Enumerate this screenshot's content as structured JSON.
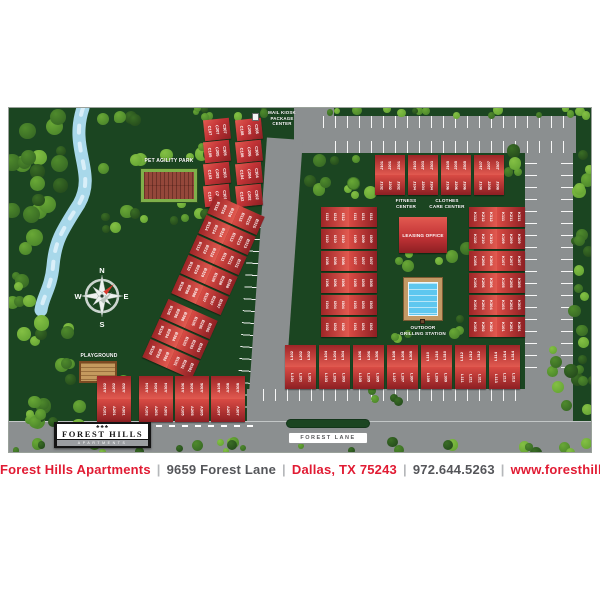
{
  "map": {
    "background": "#1b4521",
    "road_color": "#8b8f90",
    "building_color": "#c53437",
    "water_color": "#a8d8ea",
    "pool_color": "#5ec7ef",
    "labels": {
      "mail_kiosk": [
        "MAIL KIOSK",
        "PACKAGE",
        "CENTER"
      ],
      "pet_agility_park": "PET AGILITY PARK",
      "playground": "PLAYGROUND",
      "fitness_center": [
        "FITNESS",
        "CENTER"
      ],
      "clothes_care_center": [
        "CLOTHES",
        "CARE CENTER"
      ],
      "leasing_office": "LEASING OFFICE",
      "outdoor_grilling": [
        "OUTDOOR",
        "GRILLING STATION"
      ],
      "forest_lane": "FOREST LANE"
    },
    "compass": {
      "n": "N",
      "e": "E",
      "s": "S",
      "w": "W"
    },
    "buildings": {
      "C": [
        [
          "C107",
          "C207",
          "C307"
        ],
        [
          "C108",
          "C208",
          "C308"
        ],
        [
          "C105",
          "C205",
          "C305"
        ],
        [
          "C106",
          "C206",
          "C306"
        ],
        [
          "C103",
          "C203",
          "C303"
        ],
        [
          "C104",
          "C204",
          "C304"
        ],
        [
          "C101",
          "C201",
          "C301"
        ],
        [
          "C102",
          "C202",
          "C302"
        ]
      ],
      "B": [
        [
          [
            "B116",
            "B216",
            "B316"
          ],
          [
            "B115",
            "B215",
            "B315"
          ]
        ],
        [
          [
            "B114",
            "B214",
            "B314"
          ],
          [
            "B113",
            "B213",
            "B313"
          ]
        ],
        [
          [
            "B112",
            "B212",
            "B312"
          ],
          [
            "B111",
            "B211",
            "B311"
          ]
        ],
        [
          [
            "B110",
            "B210",
            "B310"
          ],
          [
            "B109",
            "B209",
            "B309"
          ]
        ],
        [
          [
            "B108",
            "B208",
            "B308"
          ],
          [
            "B107",
            "B207",
            "B307"
          ]
        ],
        [
          [
            "B106",
            "B206",
            "B306"
          ],
          [
            "B105",
            "B205",
            "B305"
          ]
        ],
        [
          [
            "B104",
            "B204",
            "B304"
          ],
          [
            "B103",
            "B203",
            "B303"
          ]
        ],
        [
          [
            "B102",
            "B202",
            "B302"
          ],
          [
            "B101",
            "B201",
            "B301"
          ]
        ]
      ],
      "A": [
        [
          [
            "A102",
            "A202",
            "A302"
          ],
          [
            "A101",
            "A201",
            "A301"
          ]
        ],
        [
          [
            "A104",
            "A204",
            "A304"
          ],
          [
            "A103",
            "A203",
            "A303"
          ]
        ],
        [
          [
            "A106",
            "A206",
            "A306"
          ],
          [
            "A105",
            "A205",
            "A305"
          ]
        ],
        [
          [
            "A108",
            "A208",
            "A308"
          ],
          [
            "A107",
            "A207",
            "A307"
          ]
        ]
      ],
      "J": [
        [
          [
            "J101",
            "J201",
            "J301"
          ],
          [
            "J102",
            "J202",
            "J302"
          ]
        ],
        [
          [
            "J103",
            "J203",
            "J303"
          ],
          [
            "J104",
            "J204",
            "J304"
          ]
        ],
        [
          [
            "J105",
            "J205",
            "J305"
          ],
          [
            "J106",
            "J206",
            "J306"
          ]
        ],
        [
          [
            "J107",
            "J207",
            "J307"
          ],
          [
            "J108",
            "J208",
            "J308"
          ]
        ]
      ],
      "I": [
        [
          [
            "I112",
            "I212",
            "I312"
          ],
          [
            "I111",
            "I211",
            "I311"
          ]
        ],
        [
          [
            "I110",
            "I210",
            "I310"
          ],
          [
            "I109",
            "I209",
            "I309"
          ]
        ],
        [
          [
            "I108",
            "I208",
            "I308"
          ],
          [
            "I107",
            "I207",
            "I307"
          ]
        ],
        [
          [
            "I106",
            "I206",
            "I306"
          ],
          [
            "I105",
            "I205",
            "I305"
          ]
        ],
        [
          [
            "I104",
            "I204",
            "I304"
          ],
          [
            "I103",
            "I203",
            "I303"
          ]
        ],
        [
          [
            "I102",
            "I202",
            "I302"
          ],
          [
            "I101",
            "I201",
            "I301"
          ]
        ]
      ],
      "K": [
        [
          [
            "K112",
            "K212",
            "K312"
          ],
          [
            "K111",
            "K211",
            "K311"
          ]
        ],
        [
          [
            "K110",
            "K210",
            "K310"
          ],
          [
            "K109",
            "K209",
            "K309"
          ]
        ],
        [
          [
            "K108",
            "K208",
            "K308"
          ],
          [
            "K107",
            "K207",
            "K307"
          ]
        ],
        [
          [
            "K106",
            "K206",
            "K306"
          ],
          [
            "K105",
            "K205",
            "K305"
          ]
        ],
        [
          [
            "K104",
            "K204",
            "K304"
          ],
          [
            "K103",
            "K203",
            "K303"
          ]
        ],
        [
          [
            "K102",
            "K202",
            "K302"
          ],
          [
            "K101",
            "K201",
            "K301"
          ]
        ]
      ],
      "L": [
        [
          [
            "L102",
            "L202",
            "L302"
          ],
          [
            "L101",
            "L201",
            "L301"
          ]
        ],
        [
          [
            "L104",
            "L204",
            "L304"
          ],
          [
            "L103",
            "L203",
            "L303"
          ]
        ],
        [
          [
            "L106",
            "L206",
            "L306"
          ],
          [
            "L105",
            "L205",
            "L305"
          ]
        ],
        [
          [
            "L108",
            "L208",
            "L308"
          ],
          [
            "L107",
            "L207",
            "L307"
          ]
        ],
        [
          [
            "L110",
            "L210",
            "L310"
          ],
          [
            "L109",
            "L209",
            "L309"
          ]
        ],
        [
          [
            "L112",
            "L212",
            "L312"
          ],
          [
            "L111",
            "L211",
            "L311"
          ]
        ],
        [
          [
            "L114",
            "L214",
            "L314"
          ],
          [
            "L113",
            "L213",
            "L313"
          ]
        ]
      ]
    }
  },
  "logo": {
    "icon": "♣♣♣",
    "name": "FOREST HILLS",
    "sub": "APARTMENTS"
  },
  "footer": {
    "separator": "|",
    "items": [
      {
        "name": "property-name",
        "text": "Forest Hills Apartments",
        "color": "#e11b33"
      },
      {
        "name": "street-address",
        "text": "9659 Forest Lane",
        "color": "#55565a"
      },
      {
        "name": "city-state-zip",
        "text": "Dallas, TX 75243",
        "color": "#e11b33"
      },
      {
        "name": "phone-number",
        "text": "972.644.5263",
        "color": "#55565a"
      },
      {
        "name": "website-url",
        "text": "www.foresthillstx.com",
        "color": "#e11b33"
      }
    ]
  }
}
